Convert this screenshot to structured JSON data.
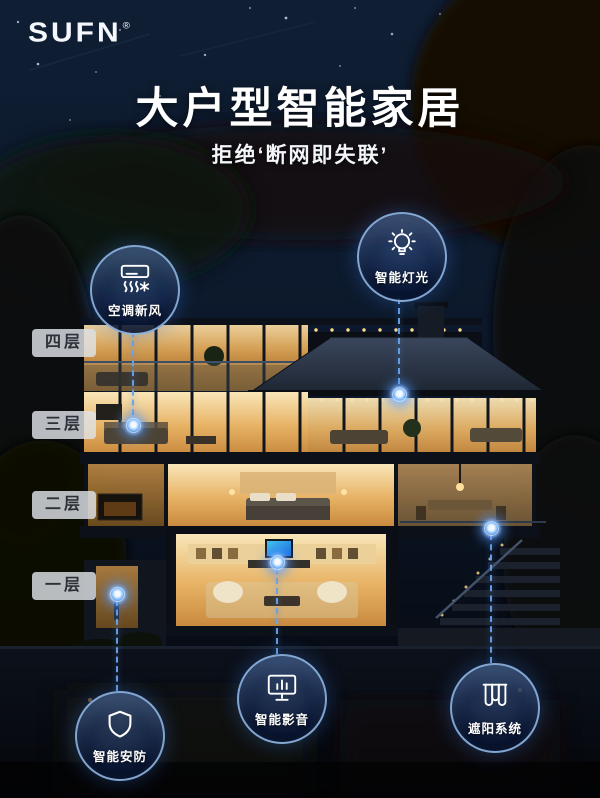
{
  "header": {
    "logo": "SUFN",
    "registered": "®",
    "title": "大户型智能家居",
    "subtitle": "拒绝‘断网即失联’"
  },
  "floors": [
    "四层",
    "三层",
    "二层",
    "一层"
  ],
  "callouts": [
    {
      "id": "hvac",
      "label": "空调新风",
      "icon": "air-conditioner-icon"
    },
    {
      "id": "lighting",
      "label": "智能灯光",
      "icon": "light-bulb-icon"
    },
    {
      "id": "security",
      "label": "智能安防",
      "icon": "shield-icon"
    },
    {
      "id": "av",
      "label": "智能影音",
      "icon": "monitor-equalizer-icon"
    },
    {
      "id": "shading",
      "label": "遮阳系统",
      "icon": "curtain-icon"
    }
  ],
  "colors": {
    "accent_blue": "#69a2e8",
    "glow_blue": "#7db8ff",
    "circle_border": "#96bee8",
    "warm_window": "#e7b264",
    "night_sky": "#0d1a2d"
  }
}
